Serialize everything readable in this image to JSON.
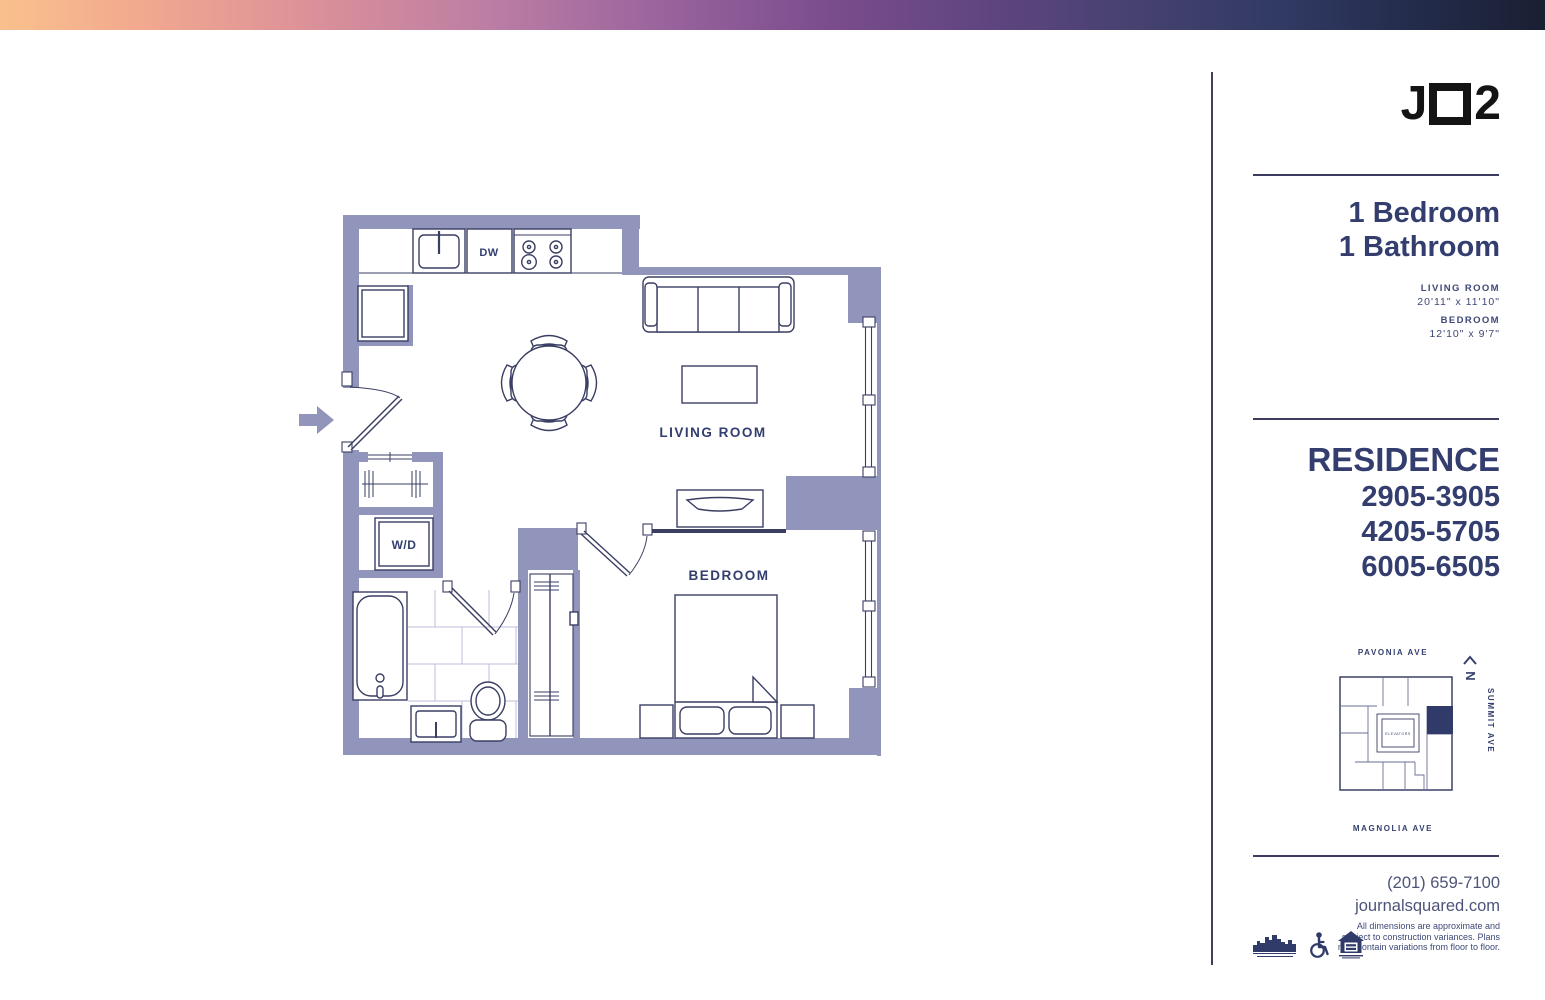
{
  "logo": {
    "j": "J",
    "two": "2"
  },
  "unit": {
    "title_line1": "1 Bedroom",
    "title_line2": "1 Bathroom",
    "dims": [
      {
        "label": "LIVING ROOM",
        "size": "20'11\" x 11'10\""
      },
      {
        "label": "BEDROOM",
        "size": "12'10\" x 9'7\""
      }
    ]
  },
  "residence": {
    "heading": "RESIDENCE",
    "lines": [
      "2905-3905",
      "4205-5705",
      "6005-6505"
    ]
  },
  "keyplan": {
    "top_street": "PAVONIA AVE",
    "bottom_street": "MAGNOLIA AVE",
    "right_street": "SUMMIT AVE",
    "north": "N",
    "core_label": "ELEVATORS"
  },
  "contact": {
    "phone": "(201) 659-7100",
    "website": "journalsquared.com"
  },
  "disclaimer": [
    "All dimensions are approximate and",
    "subject to construction variances. Plans",
    "may contain variations from floor to floor."
  ],
  "floorplan": {
    "labels": {
      "dishwasher": "DW",
      "washer_dryer": "W/D",
      "living_room": "LIVING ROOM",
      "bedroom": "BEDROOM"
    }
  },
  "icons": [
    "skyline-logo",
    "accessibility-icon",
    "equal-housing-icon"
  ],
  "colors": {
    "wall_fill": "#9295bb",
    "plan_line": "#3a3e63",
    "heading_navy": "#333e6f",
    "text_navy": "#3d4878",
    "contact_gray": "#4d5479",
    "unit_highlight": "#303b69",
    "gradient": [
      "#f9c18d",
      "#dc9199",
      "#96619c",
      "#5f4580",
      "#303a63",
      "#1a1f33"
    ]
  }
}
